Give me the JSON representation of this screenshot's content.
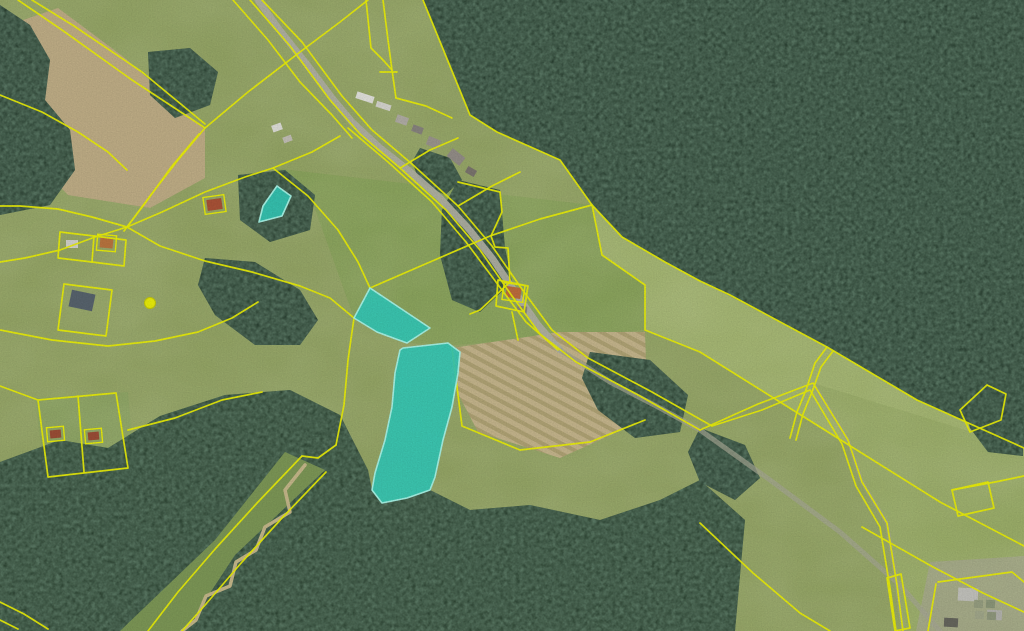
{
  "map": {
    "view": "aerial-orthophoto-with-cadastre",
    "colors": {
      "base_field": "#98a968",
      "forest": "#24392b",
      "forest_dark": "#203527",
      "boundary": "#eef20a",
      "highlight_fill": "#35cdbb",
      "highlight_stroke": "#a9f7e9",
      "road": "#b4b4a6",
      "track": "#a9ab97",
      "stream_corridor": "#7f9a58",
      "creek": "#c9bb8d",
      "tan_field": "#c3b189",
      "clearing": "#8c7f62"
    },
    "field_patches": [
      {
        "points": "592,205 622,237 700,281 827,347 917,400 1024,448 1024,546 940,502 860,452 780,402 700,352 645,330 645,285 602,255",
        "fill": "#a8ba74"
      },
      {
        "points": "273,168 592,205 602,255 645,285 645,330 455,345 407,343 377,332 354,318 310,195",
        "fill": "#8da75e"
      },
      {
        "points": "813,383 1024,448 1024,631 903,631 897,585 887,523 862,482 848,440",
        "fill": "#9fb26c"
      },
      {
        "points": "0,572 48,594 80,631 0,631",
        "fill": "#8ea863"
      },
      {
        "points": "930,562 1024,556 1024,631 916,631",
        "fill": "#a8ad8a"
      },
      {
        "points": "35,398 128,392 135,472 45,478",
        "fill": "#90a865"
      }
    ],
    "tan_fields": [
      {
        "name": "plowed-field",
        "points": "0,28 58,8 125,58 205,130 205,178 150,208 68,195 0,125",
        "fill": "#c3b189",
        "striped": false
      },
      {
        "name": "striped-dry-field",
        "points": "452,348 560,332 645,332 648,418 560,458 478,432 452,382",
        "fill": "#c9b98f",
        "striped": true
      },
      {
        "name": "forest-clearing",
        "points": "932,118 1012,120 1018,168 955,178 925,150",
        "fill": "#8c7f62",
        "striped": false
      }
    ],
    "forests": [
      {
        "points": "423,0 470,115 497,132 560,160 592,205 622,237 665,262 700,281 730,295 827,347 917,400 1024,448 1024,0"
      },
      {
        "points": "0,462 60,440 108,448 160,416 225,395 290,390 340,415 368,470 372,490 382,503 407,498 430,490 470,510 530,505 600,520 660,500 700,480 745,520 735,631 0,631",
        "fill": "#263c2b"
      },
      {
        "points": "0,5 30,25 50,60 45,100 70,130 75,170 50,205 0,215"
      },
      {
        "points": "148,52 190,48 218,72 210,105 175,118 150,95"
      },
      {
        "points": "238,175 285,170 315,195 310,230 270,242 240,220"
      },
      {
        "points": "205,258 255,262 300,290 318,320 300,345 255,345 215,315 198,285"
      },
      {
        "points": "458,180 500,190 505,248 512,282 480,312 452,300 440,255 442,210"
      },
      {
        "points": "420,148 450,158 462,180 445,195 420,182 412,162"
      },
      {
        "points": "590,352 650,360 688,395 680,432 635,438 598,410 582,378"
      },
      {
        "points": "700,428 745,445 760,478 735,500 700,482 688,452"
      },
      {
        "points": "963,402 1023,404 1023,456 988,452 970,428"
      }
    ],
    "stream": {
      "corridor_points": "285,452 325,470 235,555 185,631 120,631 215,540",
      "creek_points": "305,465 285,490 290,512 265,527 256,550 236,562 230,586 206,596 196,620 182,631"
    },
    "roads": [
      {
        "points": "258,0 278,28 305,62 332,98 352,122 380,148 408,170 440,198 468,228 492,258 515,292 538,325 560,350",
        "width": 7,
        "color": "#b4b4a6",
        "opacity": 0.95
      },
      {
        "points": "560,350 610,382 660,408 700,430 770,480 840,532 900,585 940,631",
        "width": 5,
        "color": "#a9ab97",
        "opacity": 0.7
      },
      {
        "points": "813,383 848,440 862,482 887,523 897,585 903,631",
        "width": 4,
        "color": "#a9ab97",
        "opacity": 0.6
      }
    ],
    "buildings": [
      {
        "x": 356,
        "y": 94,
        "w": 18,
        "h": 7,
        "rot": 18,
        "roof": "#e6e6e0",
        "outlined": false
      },
      {
        "x": 376,
        "y": 103,
        "w": 15,
        "h": 6,
        "rot": 18,
        "roof": "#d9d9d2",
        "outlined": false
      },
      {
        "x": 272,
        "y": 124,
        "w": 10,
        "h": 7,
        "rot": -20,
        "roof": "#e2e2dc",
        "outlined": false
      },
      {
        "x": 283,
        "y": 136,
        "w": 9,
        "h": 6,
        "rot": -20,
        "roof": "#c6c2ba",
        "outlined": false
      },
      {
        "x": 396,
        "y": 116,
        "w": 12,
        "h": 8,
        "rot": 20,
        "roof": "#b4b0a8",
        "outlined": false
      },
      {
        "x": 412,
        "y": 126,
        "w": 11,
        "h": 7,
        "rot": 20,
        "roof": "#8a8680",
        "outlined": false
      },
      {
        "x": 427,
        "y": 138,
        "w": 13,
        "h": 9,
        "rot": 22,
        "roof": "#9e9890",
        "outlined": false
      },
      {
        "x": 448,
        "y": 152,
        "w": 16,
        "h": 10,
        "rot": 38,
        "roof": "#96908a",
        "outlined": false
      },
      {
        "x": 466,
        "y": 168,
        "w": 10,
        "h": 7,
        "rot": 30,
        "roof": "#7d7770",
        "outlined": false
      },
      {
        "x": 506,
        "y": 287,
        "w": 15,
        "h": 11,
        "rot": 8,
        "roof": "#c06f3e",
        "outlined": true
      },
      {
        "x": 517,
        "y": 306,
        "w": 10,
        "h": 7,
        "rot": 8,
        "roof": "#8a8680",
        "outlined": false
      },
      {
        "x": 207,
        "y": 199,
        "w": 15,
        "h": 11,
        "rot": -8,
        "roof": "#ad5438",
        "outlined": true
      },
      {
        "x": 100,
        "y": 238,
        "w": 13,
        "h": 10,
        "rot": 5,
        "roof": "#bd7740",
        "outlined": true
      },
      {
        "x": 66,
        "y": 240,
        "w": 12,
        "h": 8,
        "rot": 0,
        "roof": "#d6d6d0",
        "outlined": false
      },
      {
        "x": 70,
        "y": 292,
        "w": 24,
        "h": 17,
        "rot": 12,
        "roof": "#59656f",
        "outlined": false
      },
      {
        "x": 50,
        "y": 430,
        "w": 11,
        "h": 8,
        "rot": -5,
        "roof": "#9e4f37",
        "outlined": true
      },
      {
        "x": 88,
        "y": 432,
        "w": 11,
        "h": 8,
        "rot": -5,
        "roof": "#9e4f37",
        "outlined": true
      },
      {
        "x": 958,
        "y": 588,
        "w": 20,
        "h": 13,
        "rot": 3,
        "roof": "#c6c6c0",
        "outlined": false
      },
      {
        "x": 987,
        "y": 610,
        "w": 15,
        "h": 10,
        "rot": 3,
        "roof": "#b6b6b0",
        "outlined": false
      },
      {
        "x": 944,
        "y": 618,
        "w": 14,
        "h": 9,
        "rot": 3,
        "roof": "#68685f",
        "outlined": false
      },
      {
        "x": 974,
        "y": 600,
        "w": 9,
        "h": 8,
        "rot": 3,
        "roof": "#99a183",
        "outlined": false
      },
      {
        "x": 986,
        "y": 600,
        "w": 9,
        "h": 8,
        "rot": 3,
        "roof": "#8e997b",
        "outlined": false
      },
      {
        "x": 975,
        "y": 611,
        "w": 9,
        "h": 8,
        "rot": 3,
        "roof": "#a4aa8d",
        "outlined": false
      },
      {
        "x": 987,
        "y": 612,
        "w": 9,
        "h": 8,
        "rot": 3,
        "roof": "#929b7f",
        "outlined": false
      }
    ],
    "boundary_lines": [
      {
        "points": "18,0 62,30 132,80 205,128"
      },
      {
        "points": "32,0 74,26 142,72 205,124"
      },
      {
        "points": "205,128 248,92 300,52 340,22 368,0"
      },
      {
        "points": "233,0 268,40 300,82 332,115 352,138"
      },
      {
        "points": "205,128 178,160 150,196 127,227"
      },
      {
        "points": "199,134 172,166 146,202 124,231"
      },
      {
        "points": "127,227 162,212 205,192 245,177 273,168 312,152 340,136"
      },
      {
        "points": "127,227 160,246 205,261 252,272 300,286 330,298 354,318"
      },
      {
        "points": "127,227 95,237 60,250 25,258 0,262"
      },
      {
        "points": "127,227 92,217 58,209 20,206 0,206"
      },
      {
        "points": "0,330 52,340 108,346 155,341 198,332 232,318 258,302"
      },
      {
        "points": "60,232 94,236 92,262 58,258 60,232"
      },
      {
        "points": "94,236 126,240 124,266 92,262"
      },
      {
        "points": "64,284 112,290 106,336 58,330 64,284"
      },
      {
        "points": "38,400 116,393 128,468 48,477 38,400"
      },
      {
        "points": "78,396 84,472"
      },
      {
        "points": "0,386 38,400"
      },
      {
        "points": "128,430 175,418 222,400 262,392"
      },
      {
        "points": "302,456 258,502 216,548 178,592 148,631"
      },
      {
        "points": "326,472 282,518 242,562 206,604 182,631"
      },
      {
        "points": "0,602 24,614 48,629"
      },
      {
        "points": "0,620 18,629"
      },
      {
        "points": "250,0 290,46 330,100 360,134 400,168 446,210 480,250 512,296 540,334 576,362 640,396 700,430"
      },
      {
        "points": "262,0 302,42 342,96 372,130 412,164 458,206 492,246 524,292 552,330 588,358 652,392 712,426"
      },
      {
        "points": "348,128 388,162 432,202 466,242 496,282 526,322 558,350"
      },
      {
        "points": "700,430 758,404 813,383 848,440 862,482 887,523 897,585 903,631"
      },
      {
        "points": "712,426 762,410 810,390 842,444 856,486 880,527 890,588 896,631"
      },
      {
        "points": "700,523 753,573 800,613 830,631"
      },
      {
        "points": "862,527 933,567 983,593 1024,612"
      },
      {
        "points": "423,0 470,115 497,132 560,160 592,205 622,237 665,262 700,281 730,295 827,347 917,400 1024,448"
      },
      {
        "points": "592,205 602,255 645,285 645,330 700,352 780,402 860,452 940,502 1024,546"
      },
      {
        "points": "827,347 815,363 806,390 797,412 790,438"
      },
      {
        "points": "833,351 821,367 812,392 803,414 796,440"
      },
      {
        "points": "987,385 1006,394 1001,420 970,432 960,410 987,385"
      },
      {
        "points": "887,578 901,574 910,628 895,631 887,578"
      },
      {
        "points": "952,490 988,482 994,508 958,516 952,490"
      },
      {
        "points": "1024,476 995,482 952,490"
      },
      {
        "points": "938,582 1012,572 1024,582"
      },
      {
        "points": "936,584 928,631"
      },
      {
        "points": "383,0 388,40 392,70 396,98"
      },
      {
        "points": "366,0 371,48 383,60 392,70"
      },
      {
        "points": "380,72 397,72"
      },
      {
        "points": "396,98 426,106 452,118"
      },
      {
        "points": "458,182 500,192 502,212 491,236 495,247 508,248 510,282 480,310 470,314"
      },
      {
        "points": "273,168 308,196 338,230 358,262 370,288"
      },
      {
        "points": "370,288 430,262 490,236 540,219 592,205"
      },
      {
        "points": "452,348 462,426 520,450 590,442 645,420"
      },
      {
        "points": "498,280 528,286 524,312 496,306 498,280"
      },
      {
        "points": "512,312 518,340"
      },
      {
        "points": "400,168 430,150 458,138"
      },
      {
        "points": "458,206 492,186 520,172"
      },
      {
        "points": "354,318 348,360 344,405 336,445"
      },
      {
        "points": "336,445 318,458 302,456"
      },
      {
        "points": "0,95 42,112 78,132 108,152 127,170"
      }
    ],
    "markers": [
      {
        "cx": 150,
        "cy": 303,
        "r": 5.5
      }
    ],
    "highlighted_parcels": [
      {
        "id": "parcel-small",
        "points": "277,186 291,196 282,216 259,222 263,206"
      },
      {
        "id": "parcel-upper",
        "points": "370,288 354,318 377,332 407,343 430,328"
      },
      {
        "id": "parcel-large",
        "points": "403,348 448,343 460,352 458,373 452,407 443,440 435,477 430,490 407,498 382,503 372,490 375,473 385,440 392,407 395,373 400,350"
      }
    ]
  }
}
